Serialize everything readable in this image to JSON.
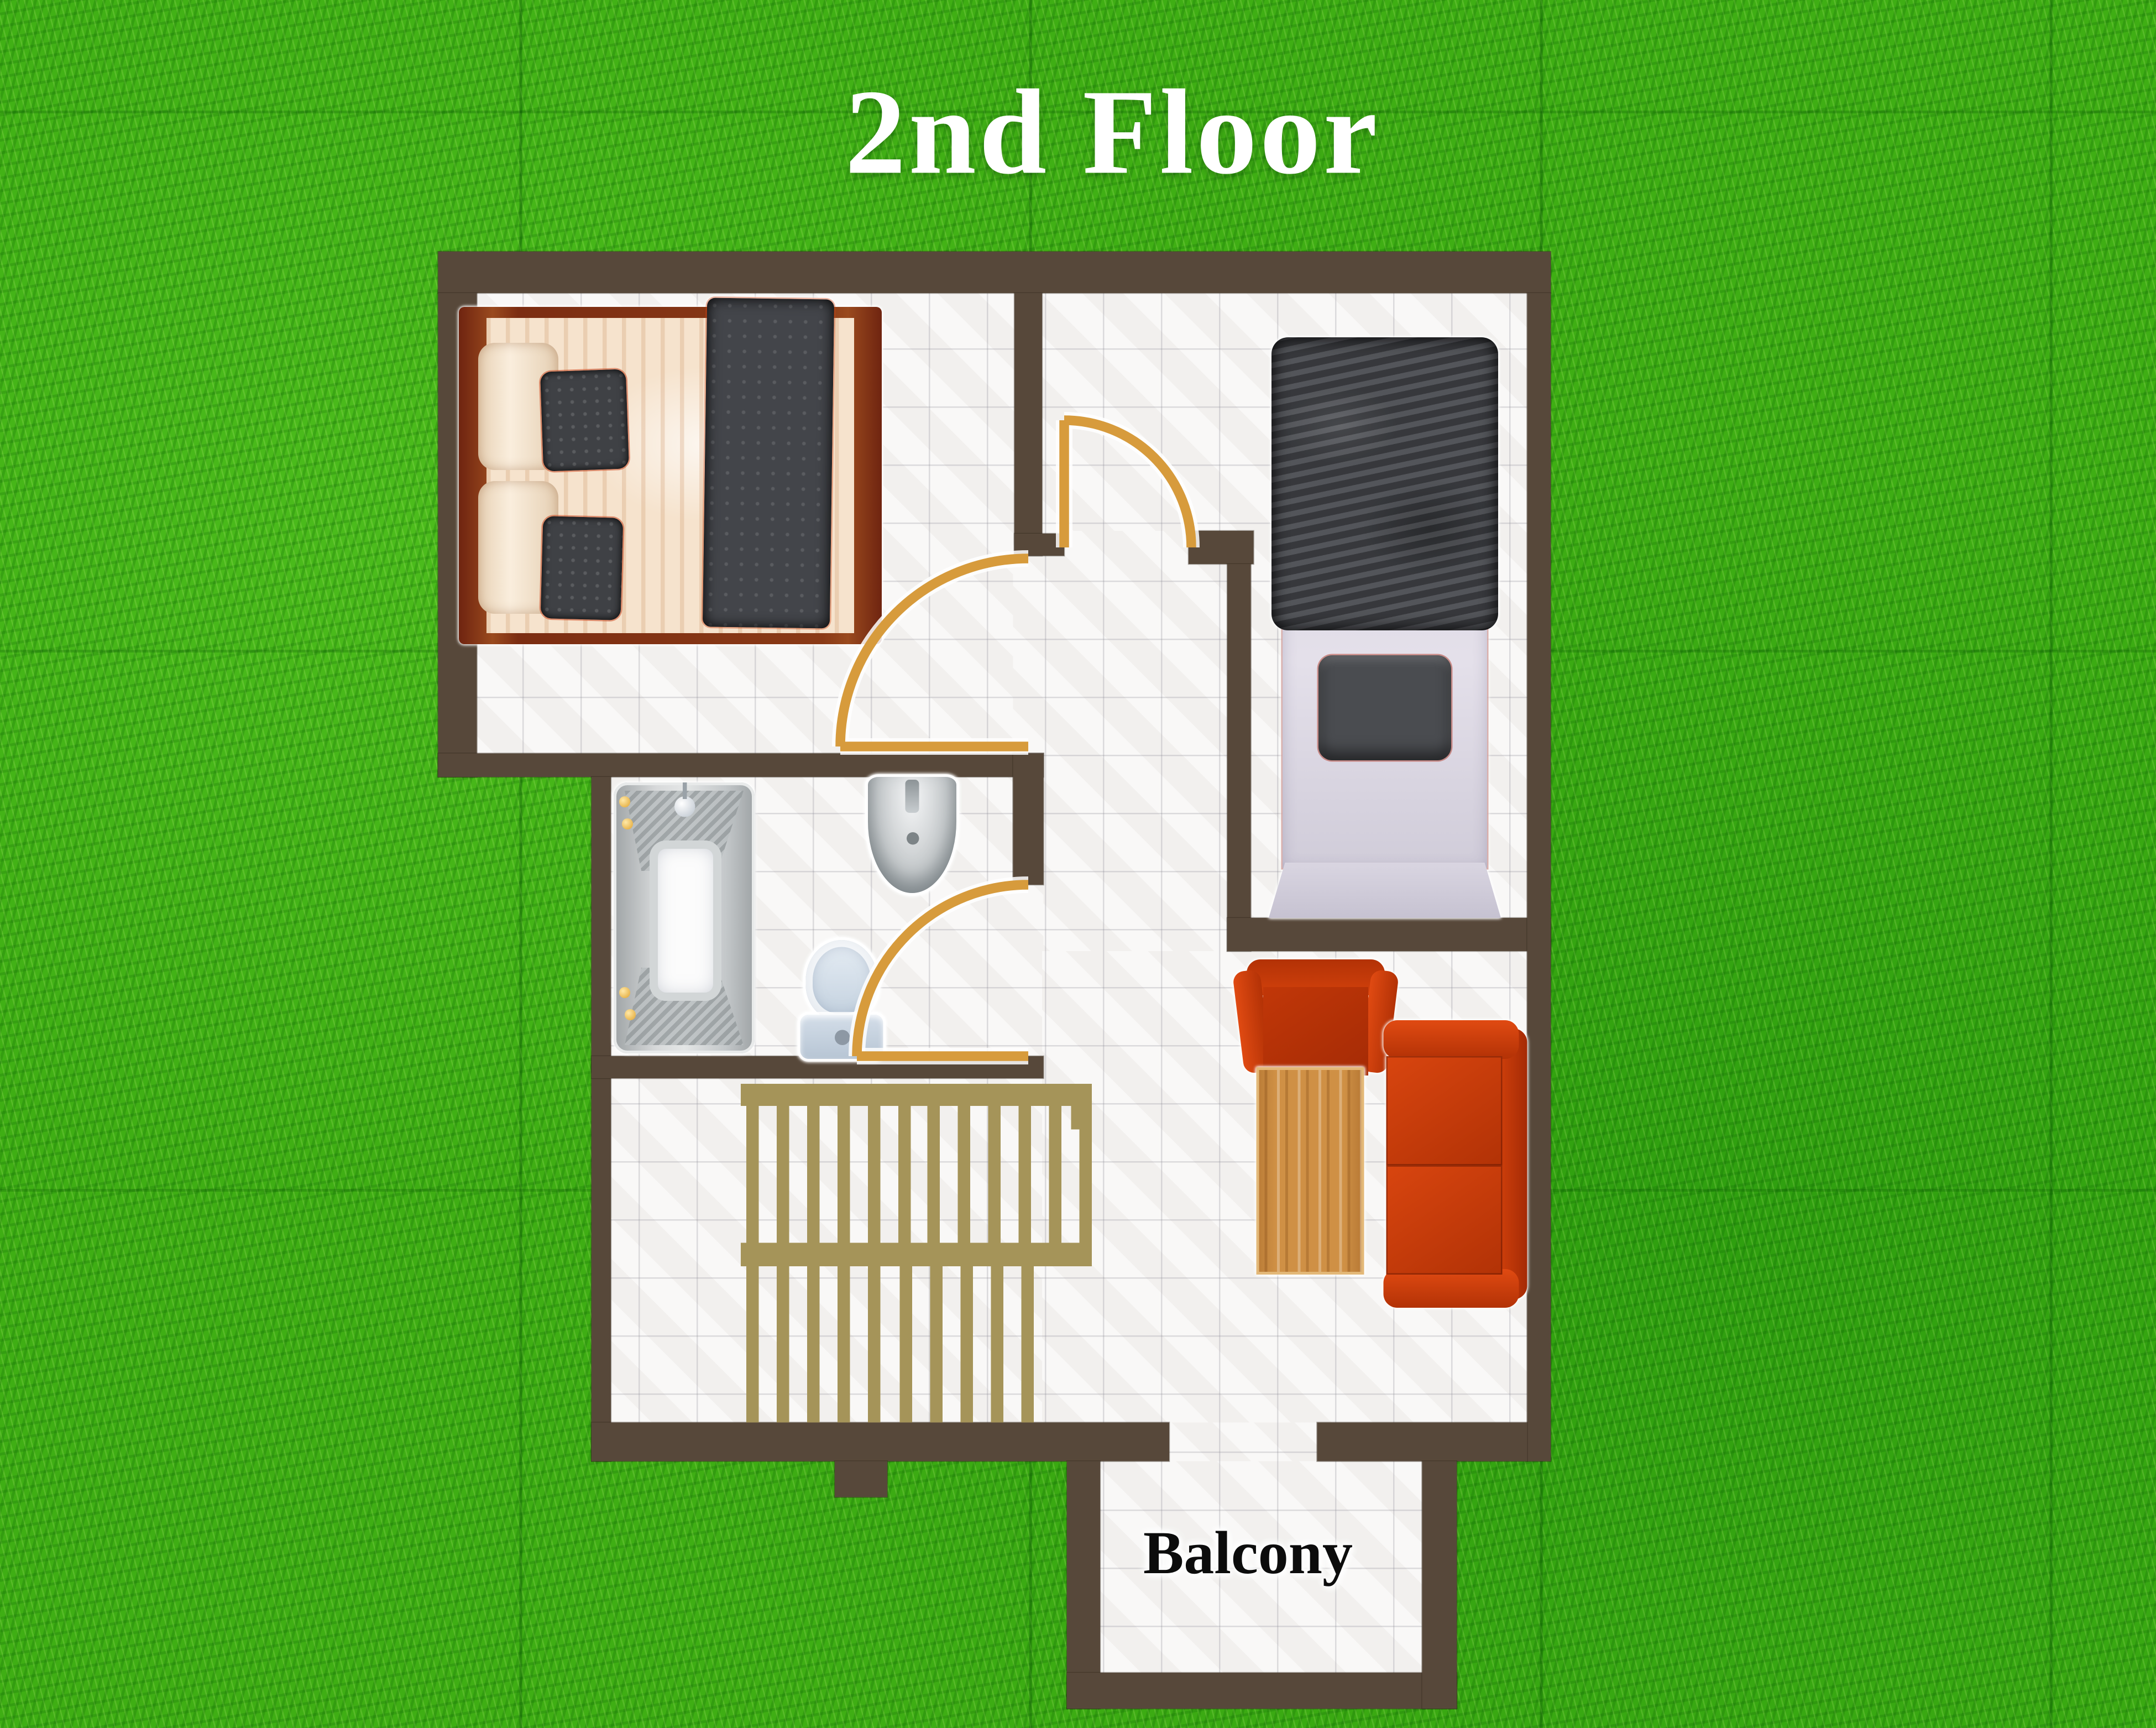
{
  "labels": {
    "title": "2nd Floor",
    "balcony": "Balcony"
  },
  "palette": {
    "grass": "#3fae14",
    "wall": "#57483a",
    "floor": "#f6f5f3",
    "door": "#d79b3c",
    "stair": "#a59459",
    "sofa_red": "#d2410c",
    "wood": "#cf9045",
    "bed_frame": "#7c2d12",
    "linen": "#f6e3cd",
    "blanket": "#43454a",
    "duvet": "#46484d",
    "sheet": "#dcd8e2",
    "fixture": "#c3d0de"
  },
  "stairs": {
    "upper_steps": 12,
    "lower_steps": 10
  },
  "furniture": [
    "double-bed",
    "single-bed",
    "bathtub",
    "wash-basin",
    "toilet",
    "staircase",
    "armchair",
    "coffee-table",
    "sofa"
  ]
}
